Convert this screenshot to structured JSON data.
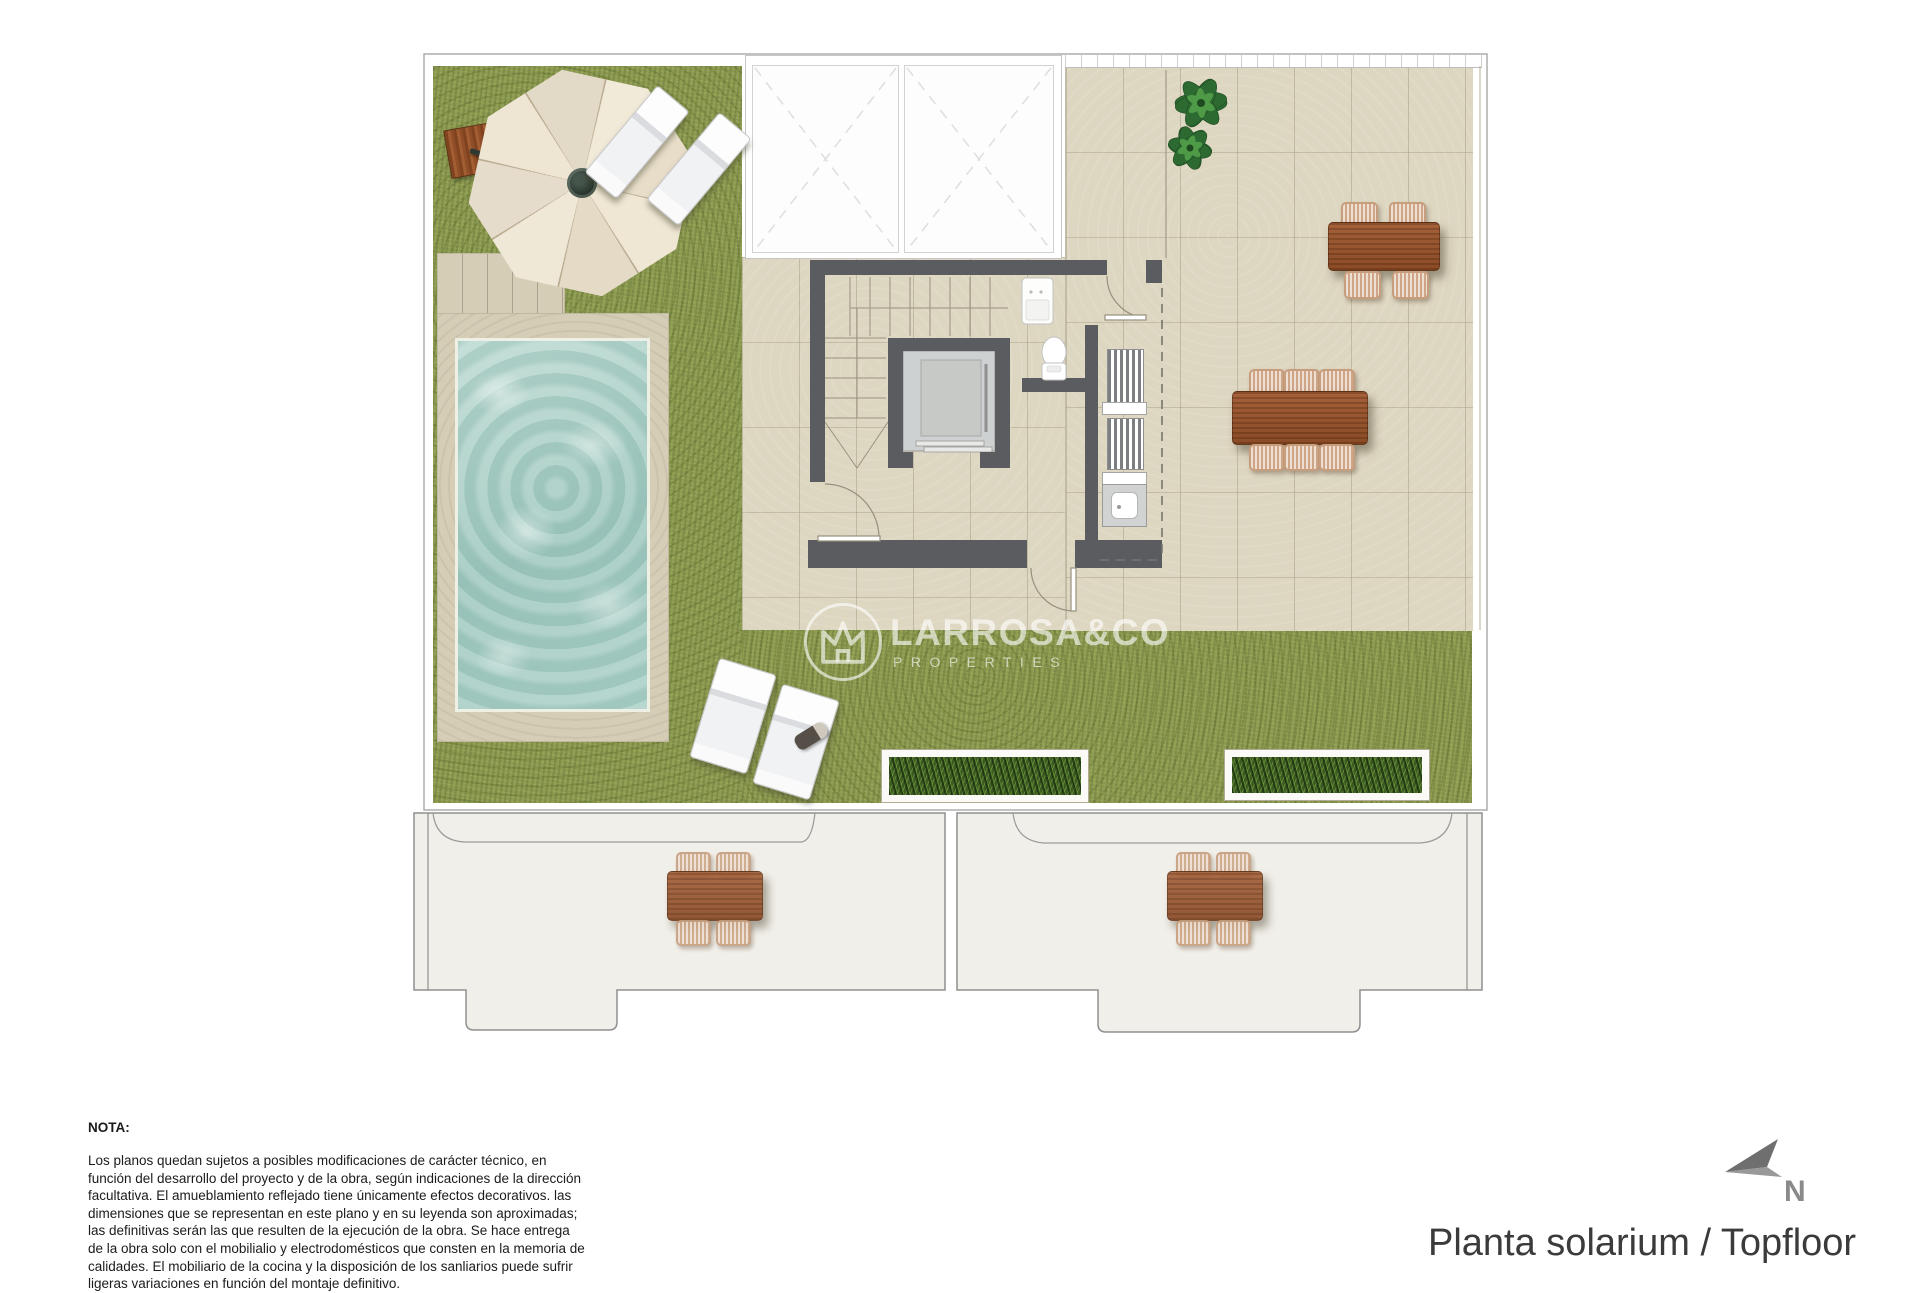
{
  "footer": {
    "title": "Planta solarium / Topfloor"
  },
  "compass": {
    "label": "N",
    "icon": "north-arrow-icon"
  },
  "watermark": {
    "brand": "LARROSA&CO",
    "subtitle": "PROPERTIES",
    "icon": "crown-house-logo-icon"
  },
  "note": {
    "heading": "NOTA:",
    "body": "Los planos quedan sujetos a posibles modificaciones de carácter técnico, en función del desarrollo del proyecto y de la obra, según indicaciones de la dirección facultativa. El amueblamiento reflejado tiene únicamente efectos decorativos. las dimensiones que se representan en este plano y en su leyenda son aproximadas; las definitivas serán las que resulten de la ejecución de la obra. Se hace entrega de la obra solo con el mobilialio y electrodomésticos que consten en la memoria de calidades. El mobiliario de la cocina y la disposición de los sanliarios puede sufrir ligeras variaciones en función del montaje definitivo."
  },
  "colors": {
    "grass": "#8c9a52",
    "terrace_tile": "#ddd6c0",
    "pool_water": "#a6cdc5",
    "pool_deck": "#d5cdb6",
    "wall_gray": "#5b5c60",
    "wood_brown": "#9a5a30",
    "wicker_tan": "#dcb99d",
    "lower_floor": "#f1efe9",
    "planter_green": "#3c5a22"
  }
}
